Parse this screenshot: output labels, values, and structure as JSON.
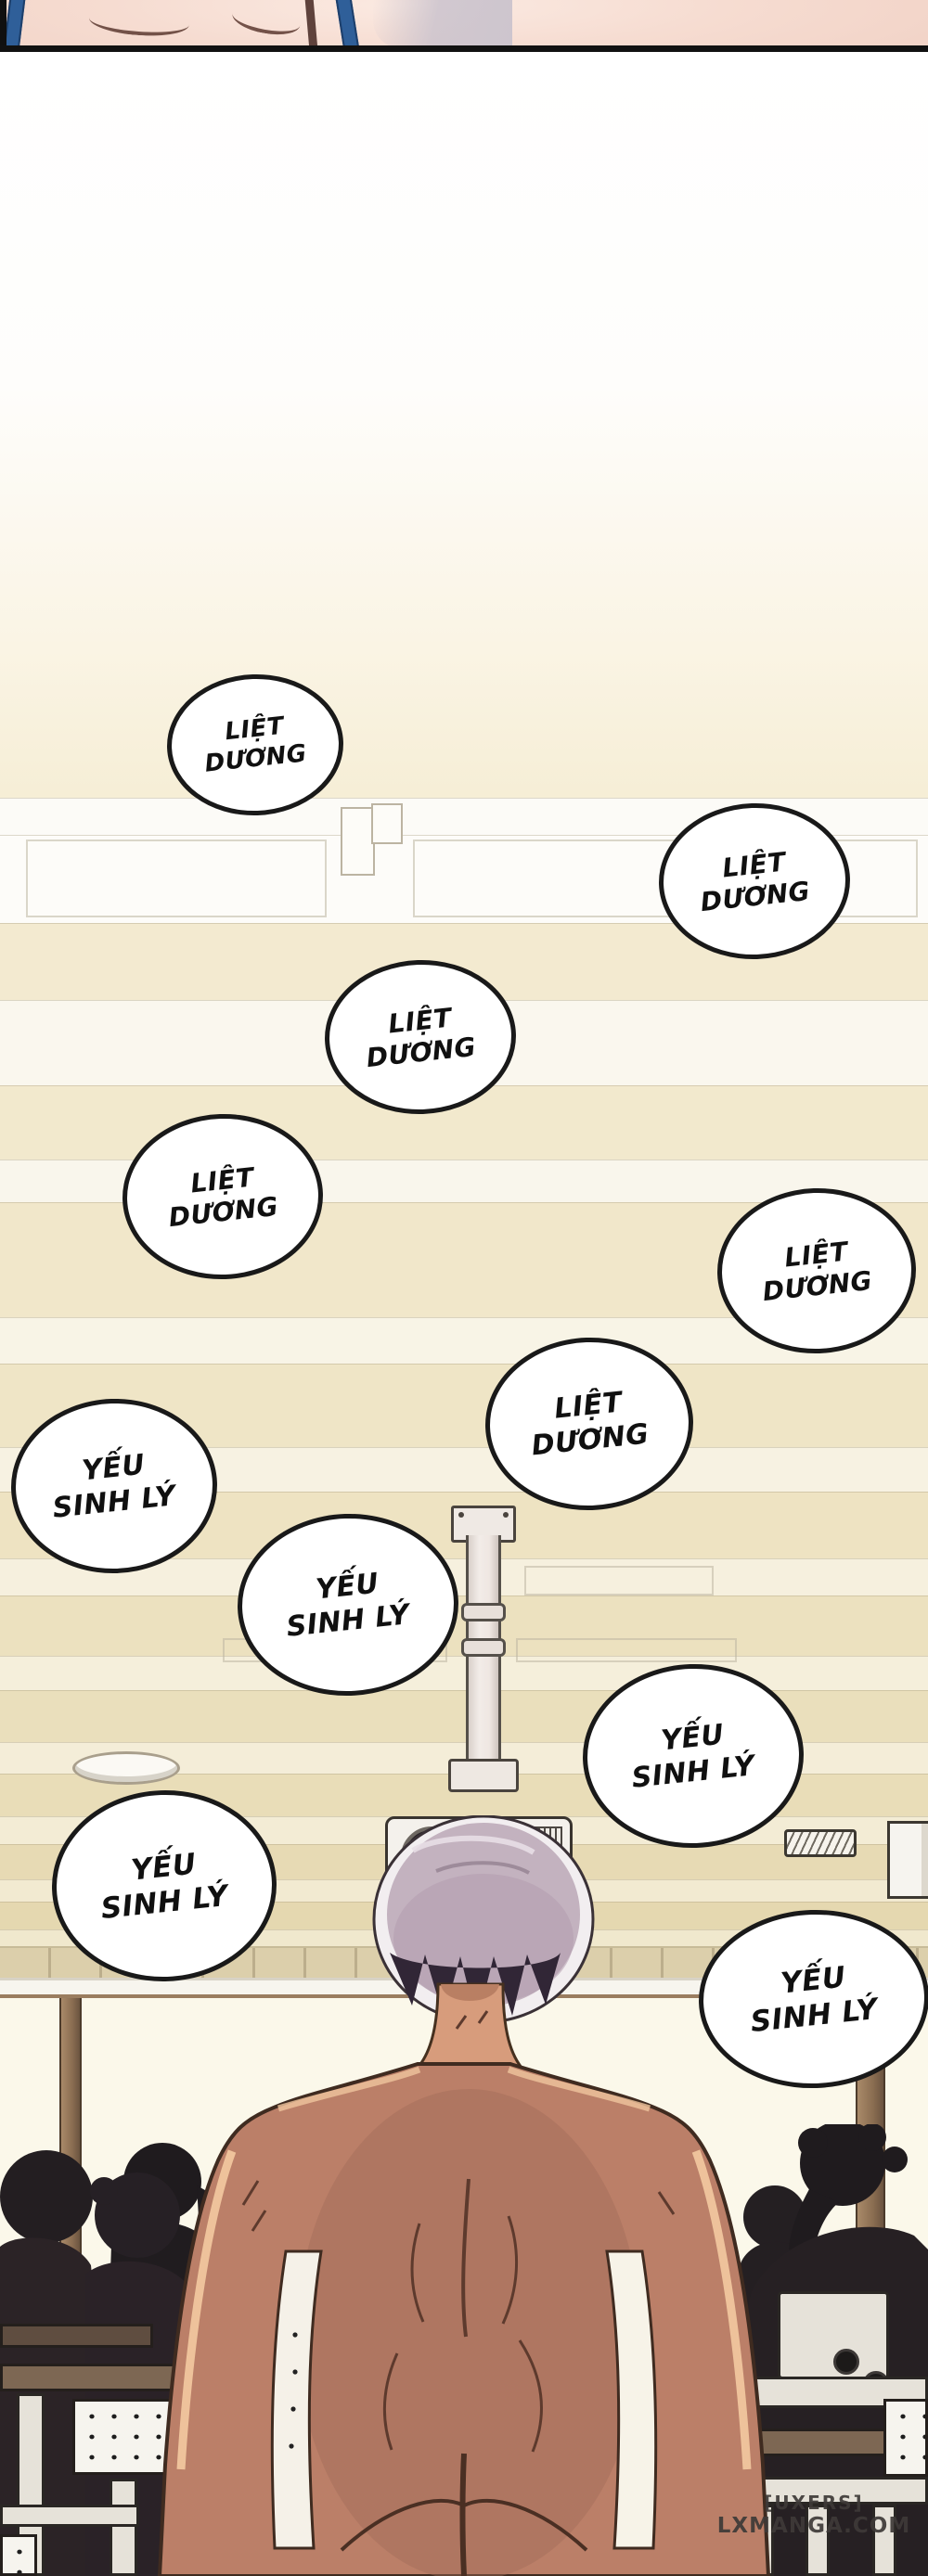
{
  "comic": {
    "bubbles": [
      {
        "line1": "LIỆT",
        "line2": "DƯƠNG"
      },
      {
        "line1": "LIỆT",
        "line2": "DƯƠNG"
      },
      {
        "line1": "LIỆT",
        "line2": "DƯƠNG"
      },
      {
        "line1": "LIỆT",
        "line2": "DƯƠNG"
      },
      {
        "line1": "LIỆT",
        "line2": "DƯƠNG"
      },
      {
        "line1": "LIỆT",
        "line2": "DƯƠNG"
      },
      {
        "line1": "YẾU",
        "line2": "SINH LÝ"
      },
      {
        "line1": "YẾU",
        "line2": "SINH LÝ"
      },
      {
        "line1": "YẾU",
        "line2": "SINH LÝ"
      },
      {
        "line1": "YẾU",
        "line2": "SINH LÝ"
      },
      {
        "line1": "YẾU",
        "line2": "SINH LÝ"
      }
    ],
    "watermark": {
      "line1": "[UXERS]",
      "line2": "LXMANGA.COM"
    }
  },
  "colors": {
    "bubble_fill": "#ffffff",
    "bubble_border": "#191919",
    "ceiling_cream": "#f1e7ca",
    "ceiling_white": "#faf7ee",
    "skin_light": "#f6dcd1",
    "skin_man": "#bb7f68",
    "hair_gray_lavender": "#c3b2bf",
    "strap_blue": "#2f5f99",
    "window_light": "#fbf8ea",
    "wood_brown": "#7d6753",
    "silhouette": "#231e21",
    "watermark_text": "#3e3a38"
  }
}
